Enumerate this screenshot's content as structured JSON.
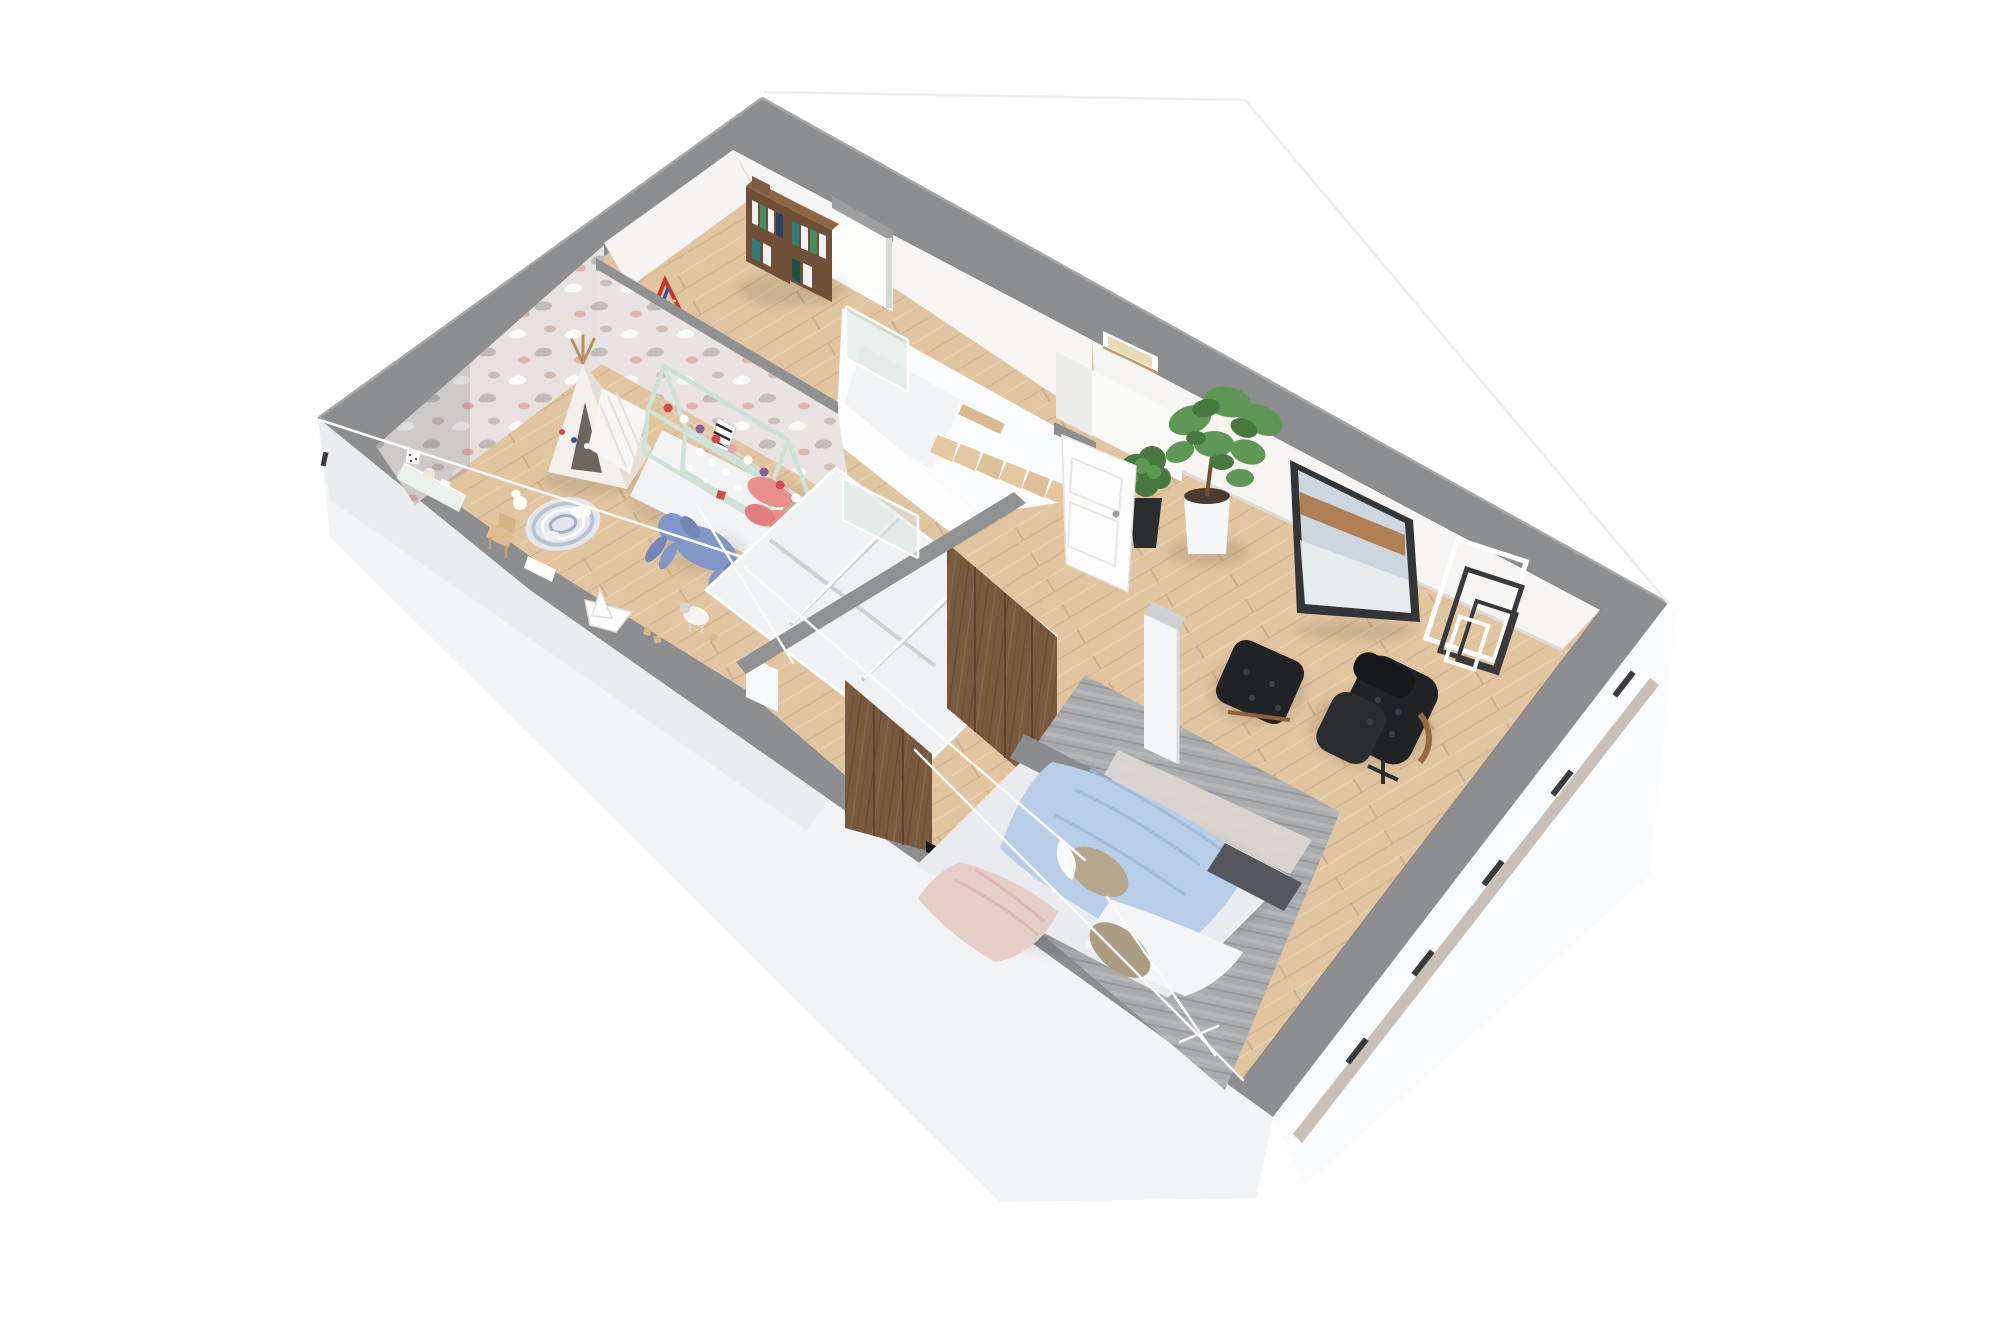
{
  "meta": {
    "kind": "3d-floor-plan-render",
    "view": "aerial cutaway, rotated ~30deg, white background",
    "floor": "upper storey"
  },
  "colors": {
    "background": "#ffffff",
    "wall_band": "#8d8e90",
    "wall_band_light": "#9d9ea0",
    "divider_band": "#909193",
    "facade": "#f1f3f5",
    "facade_shadow": "#e3e5e8",
    "fascia_rail": "#c8bfb6",
    "window_slit": "#3b3b3d",
    "floor_wood": "#e1c59f",
    "wall_face": "#f5f4f2",
    "nook_shadow": "#ececea",
    "wallpaper": "#e7e2e0",
    "cloud_gray": "#b7b2b0",
    "cloud_pink": "#e2a7a2",
    "cloud_taupe": "#c6b6ae",
    "glass": "#d7e5de",
    "stair_wood": "#e3c79d",
    "void_white": "#fbfcfd",
    "wardrobe_white": "#eff1f3",
    "walnut": "#7a5a3e",
    "walnut_dark": "#5e432e",
    "rug": "#a9abae",
    "rug_runner": "#dcd7cf",
    "bed_blue": "#b7cde8",
    "bed_white": "#f3f5f7",
    "bed_pink": "#e5cdc8",
    "bed_taupe": "#b5a68c",
    "headboard": "#8a8c8f",
    "foot_bench": "#54575b",
    "chair_leather": "#202225",
    "chair_wood": "#9a6a41",
    "plant_green": "#47793f",
    "plant_green_light": "#5f9854",
    "pot_white": "#f6f7f8",
    "pot_black": "#2b2c2e",
    "art_frame": "#333538",
    "art_sky": "#ccd6de",
    "art_rust": "#ad6f3b",
    "frame_black": "#3a3a3c",
    "door": "#fcfcfd",
    "mint": "#cfe2d8",
    "teepee": "#f3efe9",
    "plush_blue": "#8097c8",
    "pillow_pink": "#e9908d",
    "garland_red": "#d2494f",
    "garland_purple": "#8a5f9e",
    "bookshelf_walnut": "#6f4f36",
    "tv": "#161617",
    "roofline": "#ededee"
  },
  "scene": {
    "rooms": [
      {
        "name": "kids-room",
        "position": "left",
        "floor": "light oak planks",
        "features": [
          "cloud-pattern wallpaper on far walls",
          "white teepee play tent with pom-pom garland",
          "folded white play mat",
          "mint house-frame toddler bed with garland and pink pillows",
          "round striped play rug with white toys",
          "large blue bunny plush on floor",
          "toy lamb figurine",
          "white paper-boat toy",
          "wooden toddler chair",
          "wall bench tray with polka-dot cube and ball",
          "toy blocks"
        ]
      },
      {
        "name": "hallway-landing",
        "position": "top-center",
        "features": [
          "walnut bookshelf with books and crates",
          "red-blue climbing triangle leaning on partition",
          "staircase with wood treads descending",
          "glass balustrade panels",
          "small interior window with warm light"
        ]
      },
      {
        "name": "walk-in-wardrobe",
        "position": "center",
        "features": [
          "two rows of white open carcass units",
          "walnut front panels",
          "low dividing wall"
        ]
      },
      {
        "name": "bedroom",
        "position": "right",
        "floor": "light oak planks",
        "features": [
          "double bed: gray headboard, light-blue blanket, white sheet, blush duvet, taupe pillows",
          "charcoal bench at bed foot",
          "large gray area rug with pale runner",
          "black leather lounge chair",
          "black tufted ottoman",
          "white structural column",
          "fiddle-leaf fig in white cylinder pot",
          "shrub in black tapered pot",
          "leaning framed abstract artwork (blue-gray with rust streak)",
          "nested thin black and white decor frames leaning on wall",
          "open white paneled door",
          "wall-mounted tv over cut wall"
        ]
      }
    ],
    "exterior": [
      "gray wall-top band around perimeter",
      "white facade wedges below cut walls",
      "taupe fascia rail with dark window slits on south-east face",
      "faint roof wireframe lines"
    ]
  }
}
